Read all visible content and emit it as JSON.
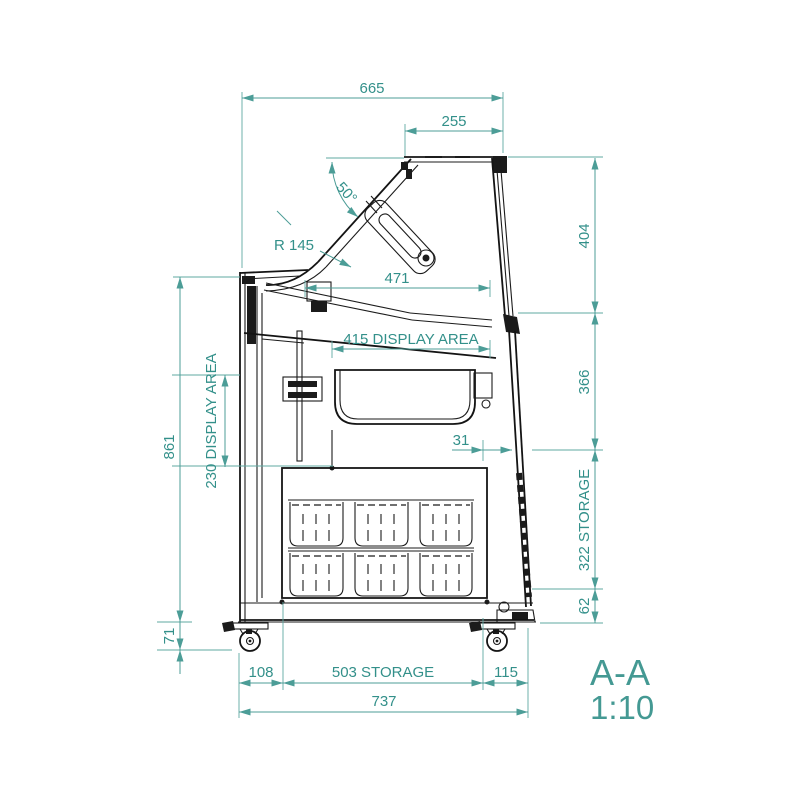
{
  "drawing": {
    "type": "technical-section-view",
    "subject": "display-case-cross-section",
    "view": {
      "label": "A-A",
      "scale": "1:10"
    },
    "colors": {
      "dimension": "#4C9D97",
      "dimension_text": "#33908A",
      "line": "#1b1b1b",
      "background": "#ffffff"
    },
    "dimensions": {
      "overall_width_top": "665",
      "lid_top_width": "255",
      "lid_angle": "50°",
      "front_radius": "R 145",
      "canopy_depth": "471",
      "display_area_depth": "415 DISPLAY AREA",
      "display_area_height": "230 DISPLAY AREA",
      "overall_height": "861",
      "upper_section_height": "404",
      "middle_section_height": "366",
      "glass_panel_offset": "31",
      "storage_section_height": "322 STORAGE",
      "base_height": "62",
      "caster_height": "71",
      "rear_bottom_offset": "108",
      "storage_depth": "503 STORAGE",
      "front_bottom_offset": "115",
      "overall_depth_bottom": "737"
    }
  }
}
